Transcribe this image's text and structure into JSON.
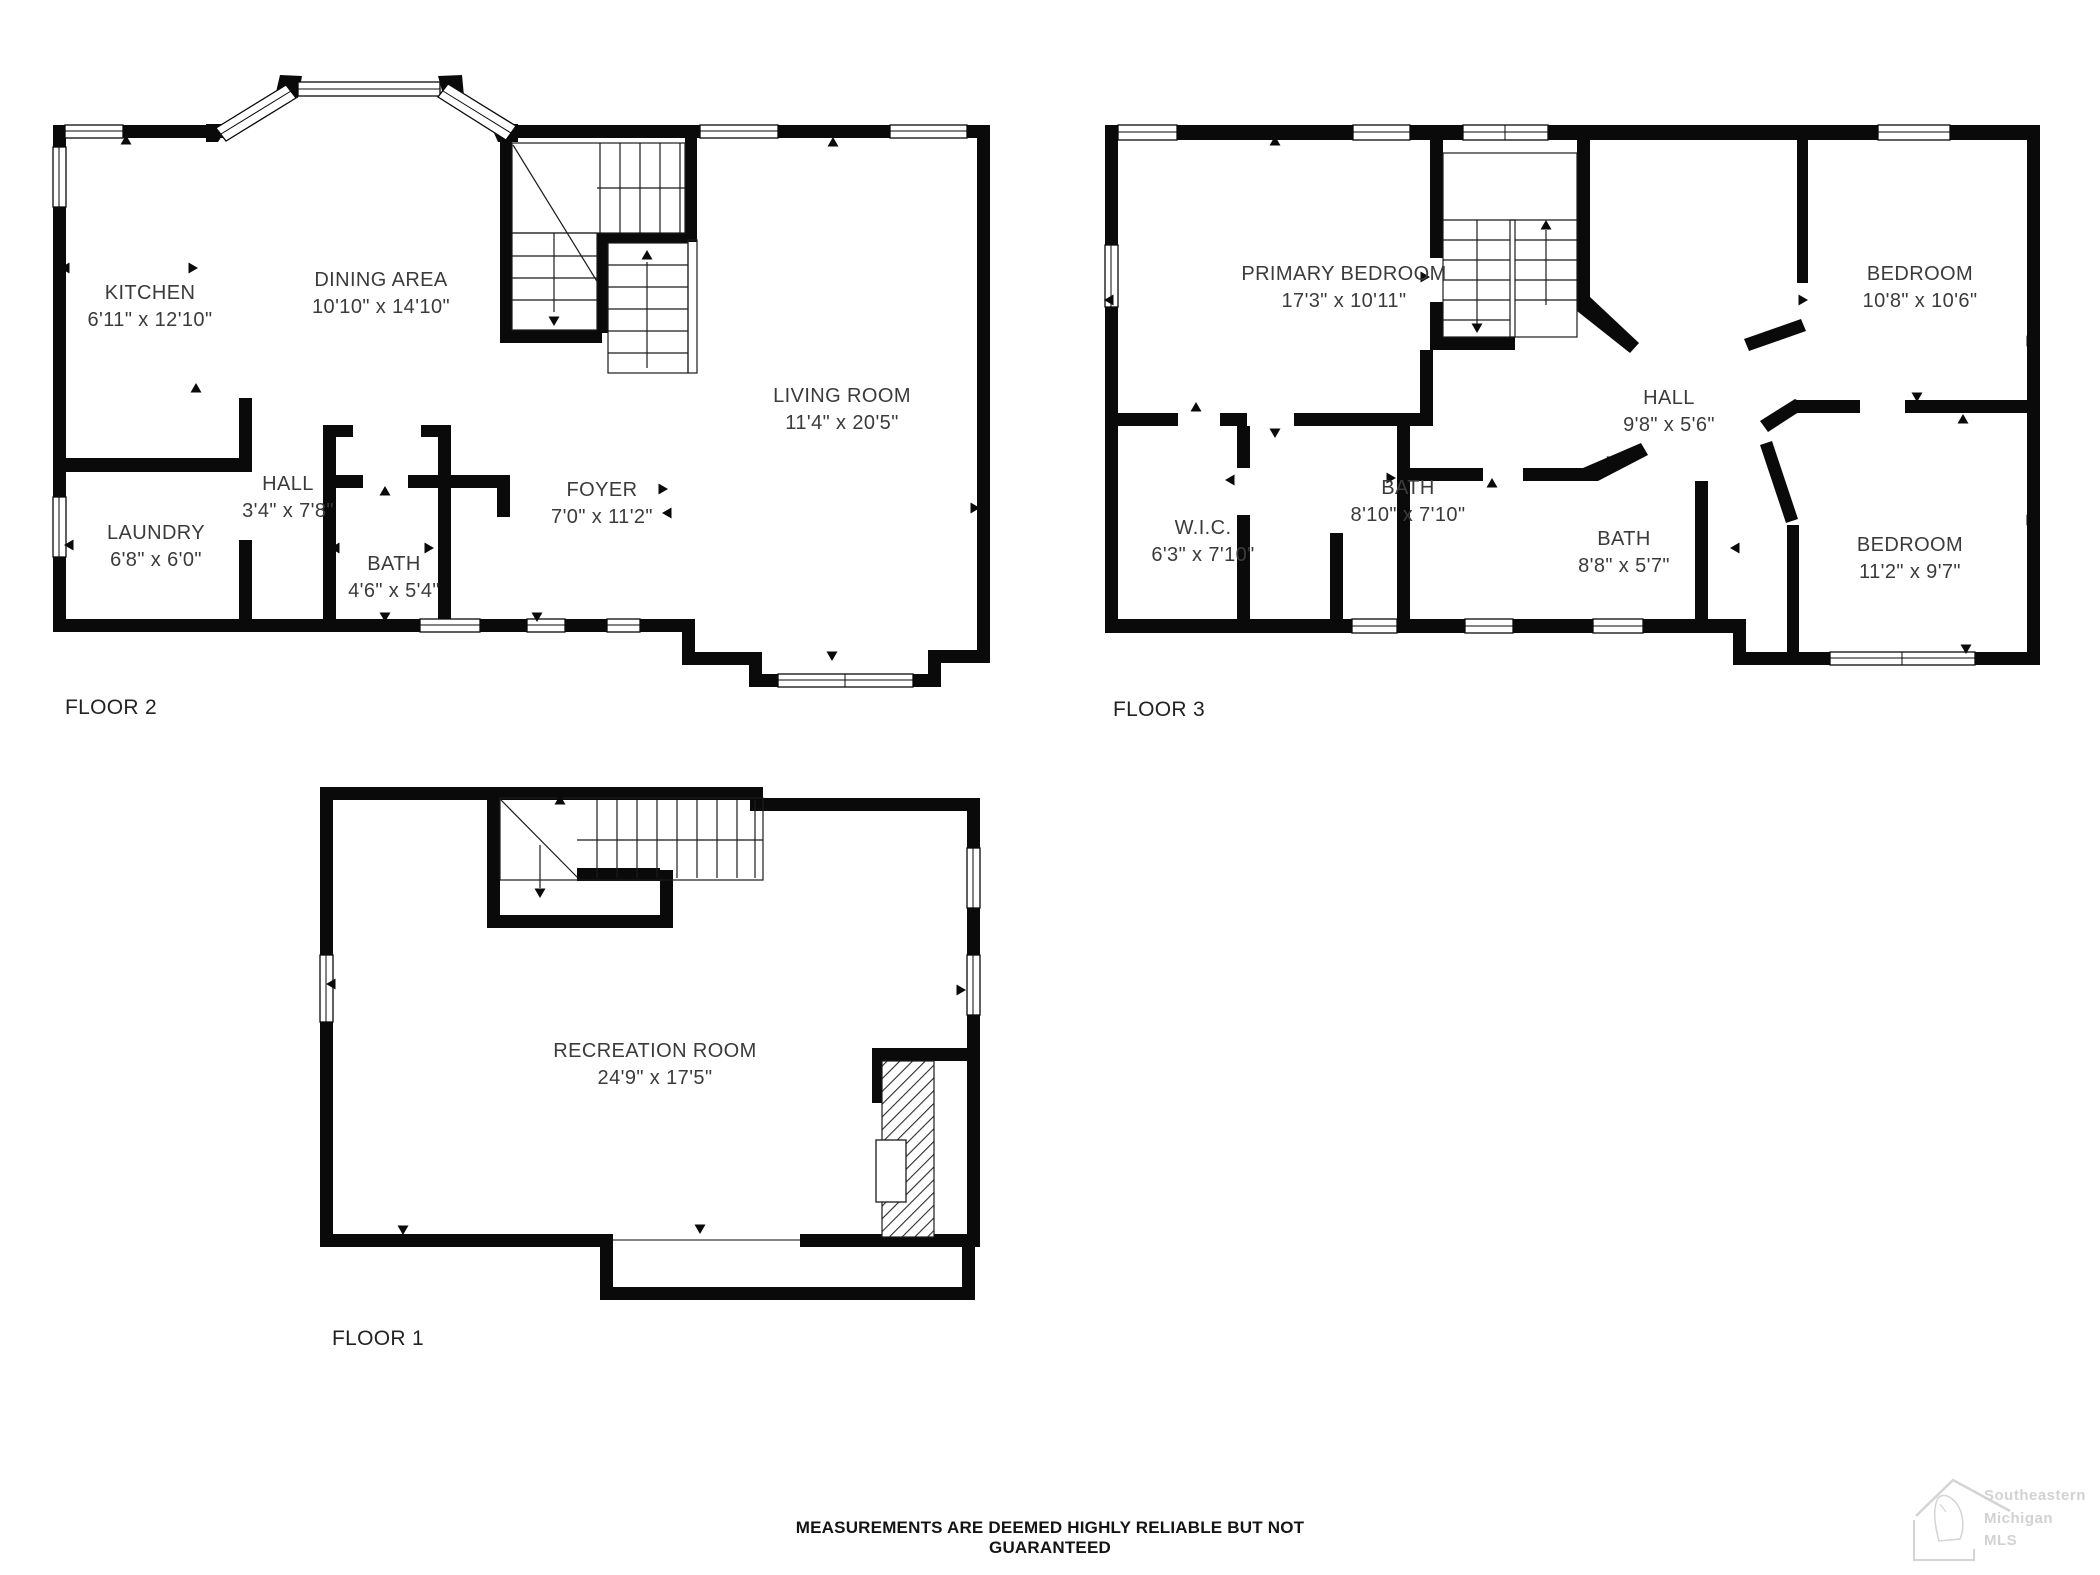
{
  "disclaimer": "MEASUREMENTS ARE DEEMED HIGHLY RELIABLE BUT NOT GUARANTEED",
  "logo": {
    "line1": "Southeastern",
    "line2": "Michigan",
    "line3": "MLS"
  },
  "floors": [
    {
      "id": "floor-2",
      "label": "FLOOR 2",
      "rooms": [
        {
          "name": "KITCHEN",
          "dims": "6'11\" x 12'10\""
        },
        {
          "name": "DINING AREA",
          "dims": "10'10\" x 14'10\""
        },
        {
          "name": "LIVING ROOM",
          "dims": "11'4\" x 20'5\""
        },
        {
          "name": "HALL",
          "dims": "3'4\" x 7'8\""
        },
        {
          "name": "LAUNDRY",
          "dims": "6'8\" x 6'0\""
        },
        {
          "name": "BATH",
          "dims": "4'6\" x 5'4\""
        },
        {
          "name": "FOYER",
          "dims": "7'0\" x 11'2\""
        }
      ]
    },
    {
      "id": "floor-3",
      "label": "FLOOR 3",
      "rooms": [
        {
          "name": "PRIMARY BEDROOM",
          "dims": "17'3\" x 10'11\""
        },
        {
          "name": "BEDROOM",
          "dims": "10'8\" x 10'6\""
        },
        {
          "name": "HALL",
          "dims": "9'8\" x 5'6\""
        },
        {
          "name": "W.I.C.",
          "dims": "6'3\" x 7'10\""
        },
        {
          "name": "BATH",
          "dims": "8'10\" x 7'10\""
        },
        {
          "name": "BATH",
          "dims": "8'8\" x 5'7\""
        },
        {
          "name": "BEDROOM",
          "dims": "11'2\" x 9'7\""
        }
      ]
    },
    {
      "id": "floor-1",
      "label": "FLOOR 1",
      "rooms": [
        {
          "name": "RECREATION ROOM",
          "dims": "24'9\" x 17'5\""
        }
      ]
    }
  ]
}
